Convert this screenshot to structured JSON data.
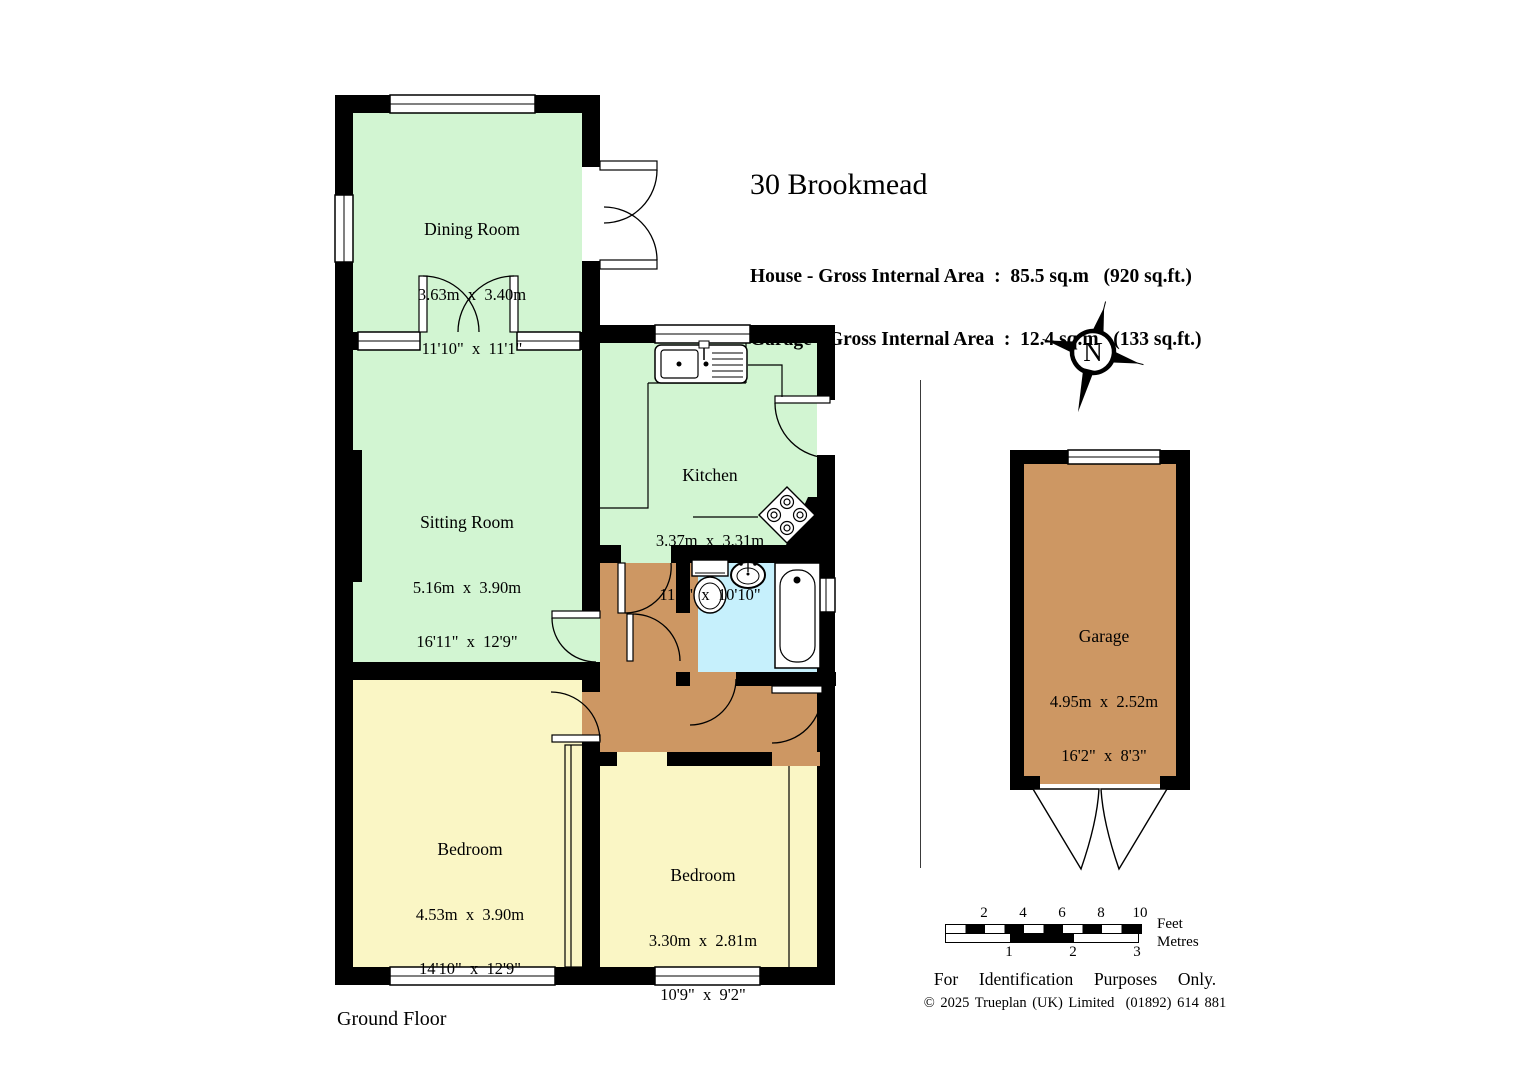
{
  "header": {
    "title": "30 Brookmead",
    "house_area_line": "House - Gross Internal Area  :  85.5 sq.m   (920 sq.ft.)",
    "garage_area_line": "Garage - Gross Internal Area  :  12.4 sq.m   (133 sq.ft.)"
  },
  "rooms": [
    {
      "name": "Dining Room",
      "metric": "3.63m  x  3.40m",
      "imperial": "11'10\"  x  11'1\""
    },
    {
      "name": "Sitting Room",
      "metric": "5.16m  x  3.90m",
      "imperial": "16'11\"  x  12'9\""
    },
    {
      "name": "Kitchen",
      "metric": "3.37m  x  3.31m",
      "imperial": "11'0\"  x  10'10\""
    },
    {
      "name": "Bedroom",
      "metric": "4.53m  x  3.90m",
      "imperial": "14'10\"  x  12'9\""
    },
    {
      "name": "Bedroom",
      "metric": "3.30m  x  2.81m",
      "imperial": "10'9\"  x  9'2\""
    },
    {
      "name": "Garage",
      "metric": "4.95m  x  2.52m",
      "imperial": "16'2\"  x  8'3\""
    }
  ],
  "compass": {
    "label": "N"
  },
  "scalebar": {
    "feet_ticks": [
      "2",
      "4",
      "6",
      "8",
      "10"
    ],
    "metre_ticks": [
      "1",
      "2",
      "3"
    ],
    "feet_label": "Feet",
    "metres_label": "Metres"
  },
  "footer": {
    "disclaimer": "For  Identification  Purposes  Only.",
    "copyright": "© 2025 Trueplan (UK) Limited  (01892) 614 881",
    "floor_label": "Ground Floor"
  },
  "colors": {
    "room_green": "#d2f5d2",
    "room_yellow": "#faf6c5",
    "hall_brown": "#cd9763",
    "garage_brown": "#cd9763",
    "bathroom_blue": "#c6f0fc",
    "wall_black": "#000000"
  }
}
